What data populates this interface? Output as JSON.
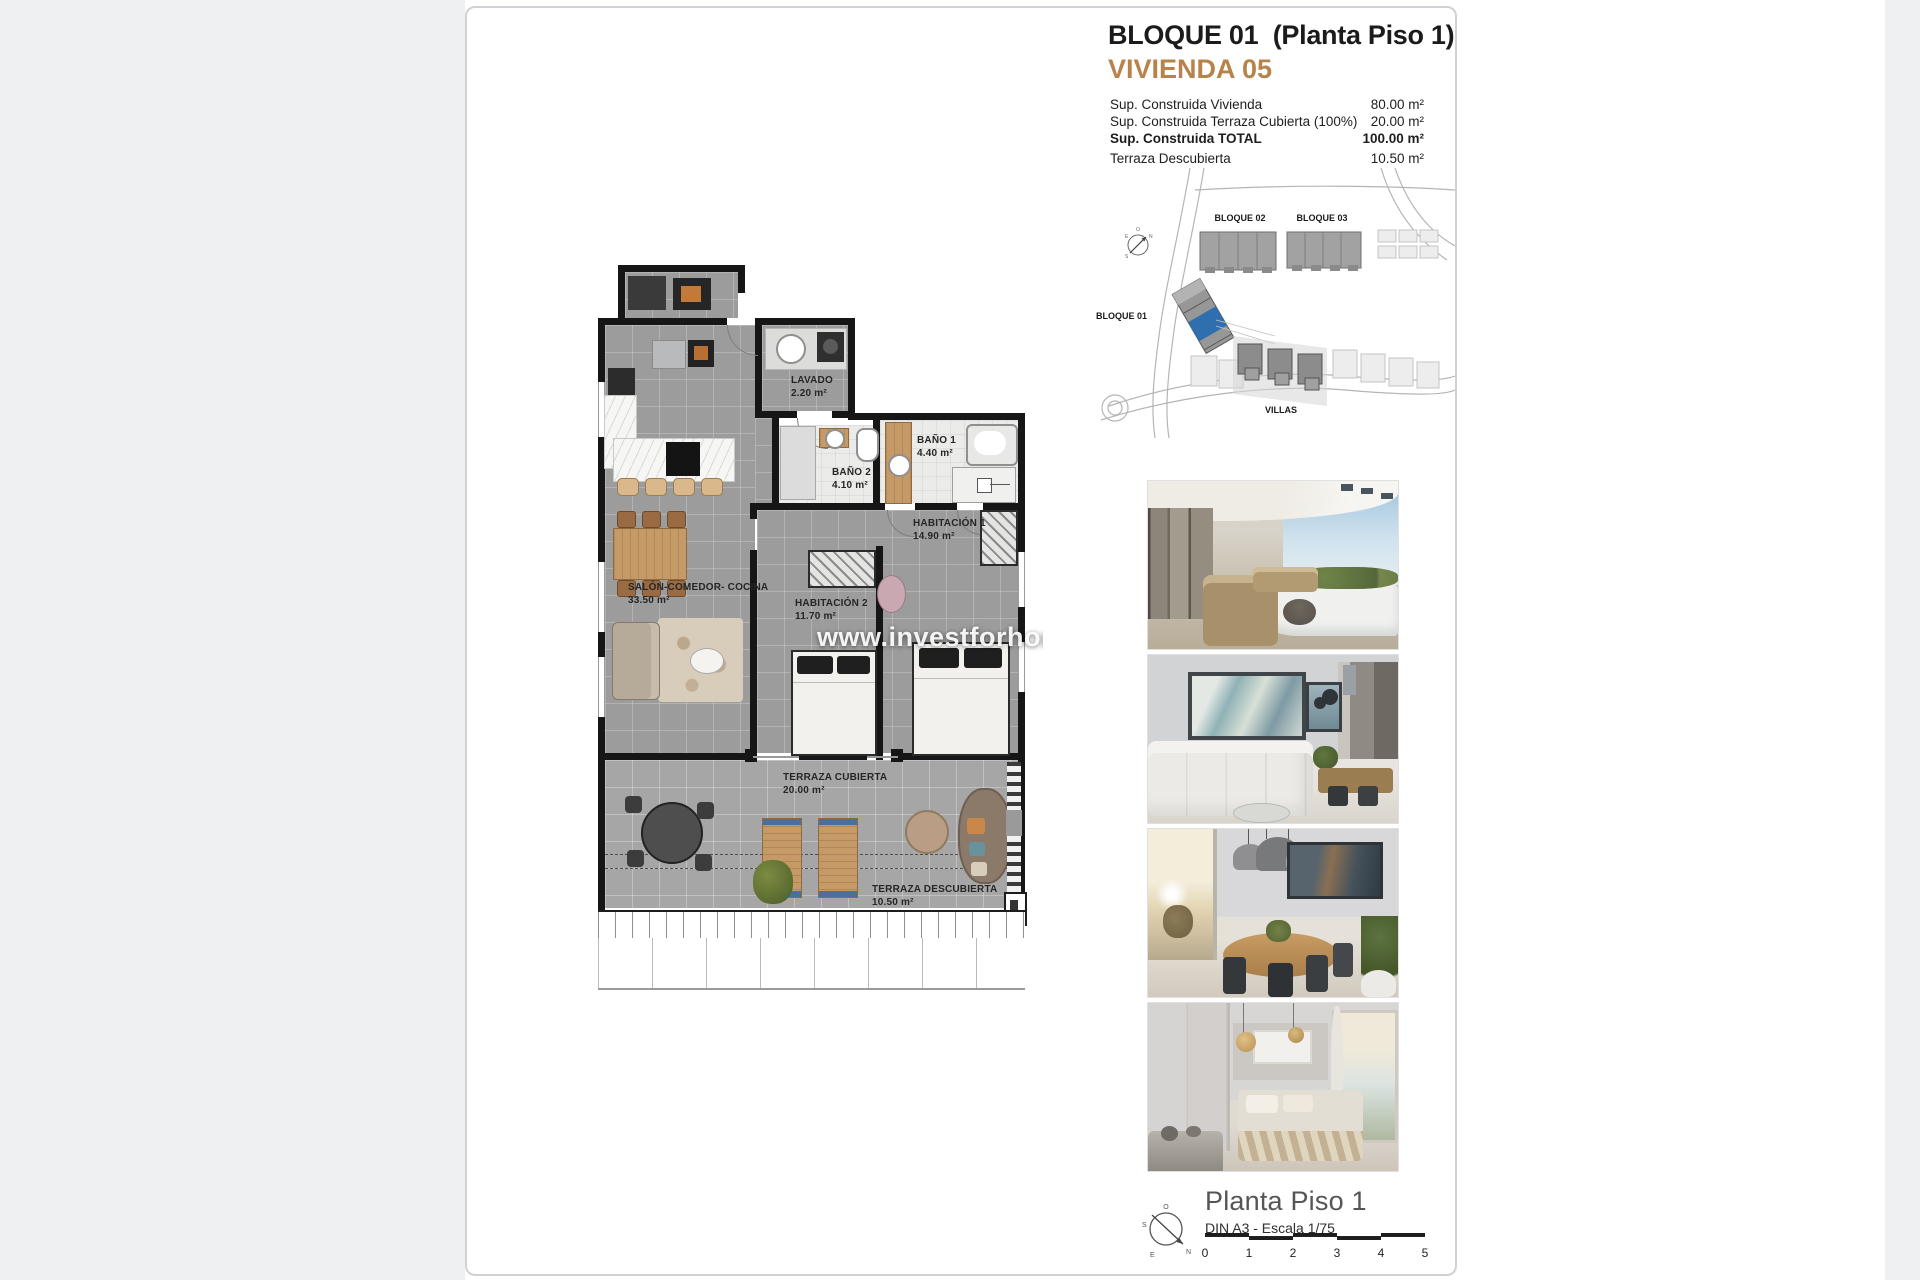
{
  "document": {
    "header": {
      "title": "BLOQUE 01  (Planta Piso 1)",
      "subtitle": "VIVIENDA 05",
      "accent_color": "#b8834b",
      "rows": [
        {
          "label": "Sup. Construida Vivienda",
          "value": "80.00 m²"
        },
        {
          "label": "Sup. Construida Terraza Cubierta (100%)",
          "value": "20.00 m²"
        },
        {
          "label": "Sup. Construida TOTAL",
          "value": "100.00 m²"
        },
        {
          "label": "Terraza Descubierta",
          "value": "10.50 m²"
        }
      ]
    },
    "site_plan": {
      "bloque01": "BLOQUE 01",
      "bloque02": "BLOQUE 02",
      "bloque03": "BLOQUE 03",
      "villas": "VILLAS",
      "highlight_color": "#2f6fb0"
    },
    "floor_plan": {
      "watermark": "www.investforhom",
      "rooms": {
        "lavado": {
          "name": "LAVADO",
          "area": "2.20 m²"
        },
        "bano1": {
          "name": "BAÑO 1",
          "area": "4.40 m²"
        },
        "bano2": {
          "name": "BAÑO 2",
          "area": "4.10 m²"
        },
        "habitacion1": {
          "name": "HABITACIÓN 1",
          "area": "14.90 m²"
        },
        "habitacion2": {
          "name": "HABITACIÓN 2",
          "area": "11.70 m²"
        },
        "salon": {
          "name": "SALÓN-COMEDOR- COCINA",
          "area": "33.50 m²"
        },
        "terraza_cubierta": {
          "name": "TERRAZA CUBIERTA",
          "area": "20.00 m²"
        },
        "terraza_descubierta": {
          "name": "TERRAZA DESCUBIERTA",
          "area": "10.50 m²"
        }
      }
    },
    "photos": [
      {
        "name": "terrace-exterior"
      },
      {
        "name": "living-room"
      },
      {
        "name": "dining-room"
      },
      {
        "name": "bedroom"
      }
    ],
    "footer": {
      "title": "Planta Piso 1",
      "scale_note": "DIN A3 - Escala 1/75",
      "scale_ticks": [
        "0",
        "1",
        "2",
        "3",
        "4",
        "5"
      ],
      "compass": {
        "n": "N",
        "s": "S",
        "e": "E",
        "o": "O"
      }
    }
  }
}
